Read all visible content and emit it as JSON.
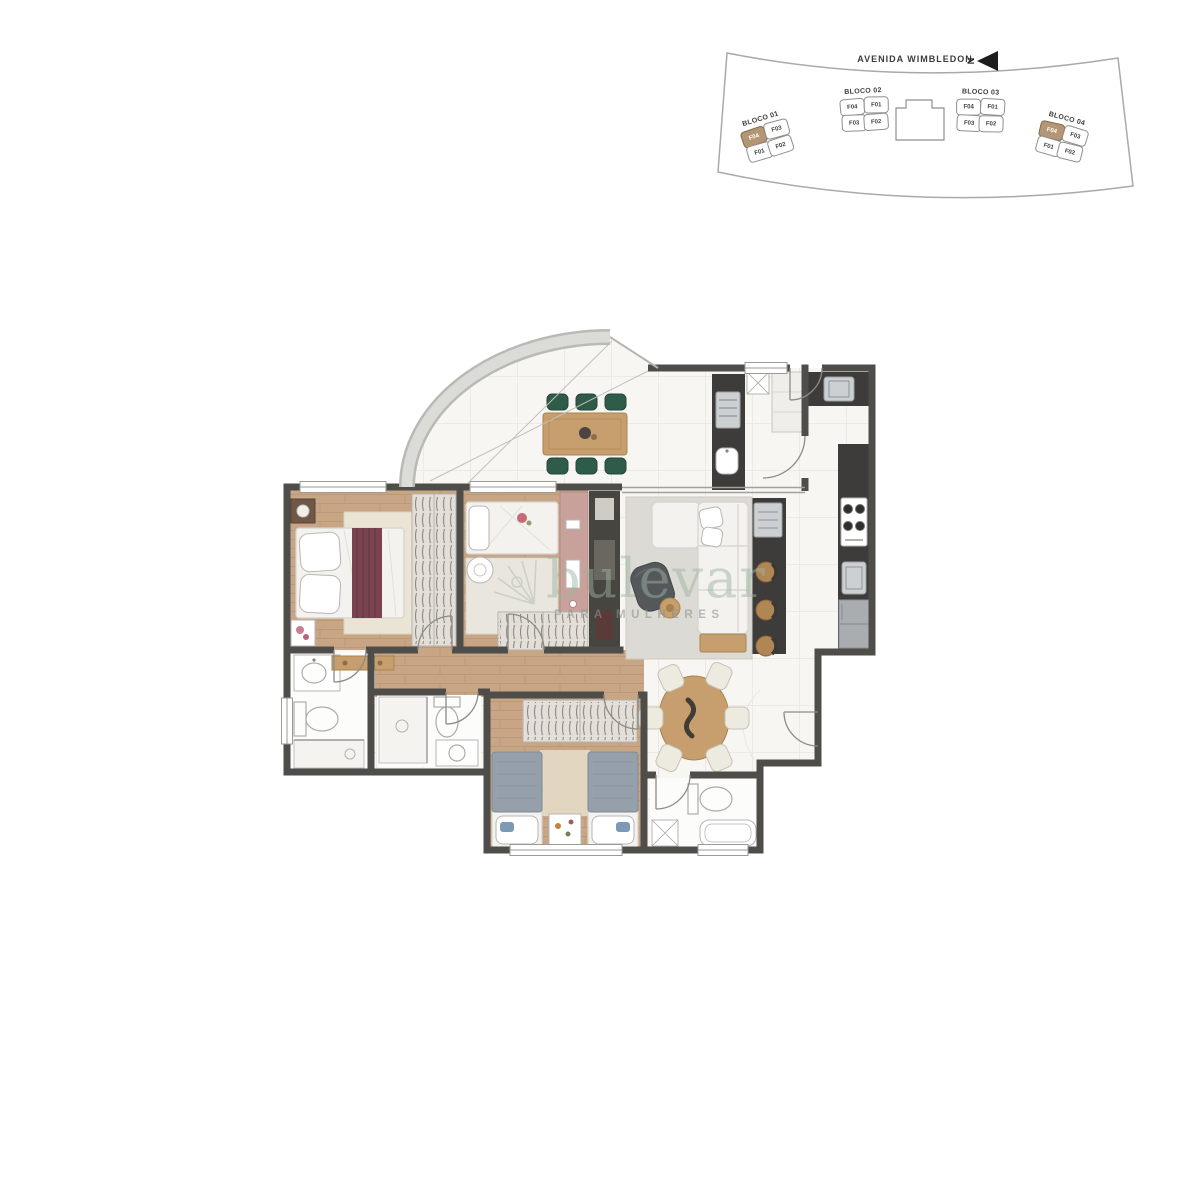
{
  "site_map": {
    "street_label": "AVENIDA WIMBLEDON",
    "north_label": "N",
    "highlight_color": "#b49674",
    "blocks": [
      {
        "name": "BLOCO 01",
        "units": [
          {
            "label": "F04",
            "highlighted": true
          },
          {
            "label": "F03",
            "highlighted": false
          },
          {
            "label": "F01",
            "highlighted": false
          },
          {
            "label": "F02",
            "highlighted": false
          }
        ]
      },
      {
        "name": "BLOCO 02",
        "units": [
          {
            "label": "F04",
            "highlighted": false
          },
          {
            "label": "F01",
            "highlighted": false
          },
          {
            "label": "F03",
            "highlighted": false
          },
          {
            "label": "F02",
            "highlighted": false
          }
        ]
      },
      {
        "name": "BLOCO 03",
        "units": [
          {
            "label": "F04",
            "highlighted": false
          },
          {
            "label": "F01",
            "highlighted": false
          },
          {
            "label": "F03",
            "highlighted": false
          },
          {
            "label": "F02",
            "highlighted": false
          }
        ]
      },
      {
        "name": "BLOCO 04",
        "units": [
          {
            "label": "F04",
            "highlighted": true
          },
          {
            "label": "F03",
            "highlighted": false
          },
          {
            "label": "F01",
            "highlighted": false
          },
          {
            "label": "F02",
            "highlighted": false
          }
        ]
      }
    ]
  },
  "watermark": {
    "brand": "bulevar",
    "tagline": "PARA MULHERES",
    "color": "#9cb3a2"
  },
  "floor_plan": {
    "colors": {
      "wall": "#4e4d4a",
      "wood_floor": "#c8a685",
      "tile": "#f7f6f3",
      "bath_floor": "#fcfcfb",
      "counter_dark": "#3d3c3a",
      "accent_green": "#2f5b49",
      "accent_maroon": "#7b4350",
      "accent_pink": "#c8a29a",
      "accent_tan": "#c79e6d"
    }
  }
}
